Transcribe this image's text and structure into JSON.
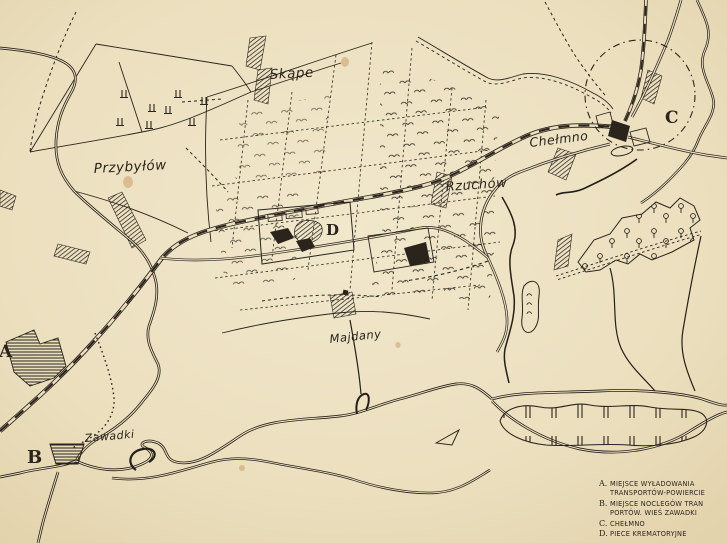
{
  "colors": {
    "paper": "#ecdfbf",
    "ink": "#2a241c"
  },
  "labels": {
    "skape": "Skąpe",
    "przybylow": "Przybyłów",
    "chelmno": "Chełmno",
    "rzuchow": "Rzuchów",
    "majdany": "Majdany",
    "zawadki": "Zawadki"
  },
  "markers": {
    "a": "A",
    "b": "B",
    "c": "C",
    "d": "D"
  },
  "legend": {
    "lines": [
      {
        "key": "A.",
        "text": "MIEJSCE WYŁADOWANIA"
      },
      {
        "key": "",
        "text": "TRANSPORTÓW-POWIERCIE"
      },
      {
        "key": "B.",
        "text": "MIEJSCE NOCLEGÓW TRAN"
      },
      {
        "key": "",
        "text": "PORTÓW. WIEŚ ZAWADKI"
      },
      {
        "key": "C.",
        "text": "CHEŁMNO"
      },
      {
        "key": "D.",
        "text": "PIECE KREMATORYJNE"
      }
    ]
  }
}
